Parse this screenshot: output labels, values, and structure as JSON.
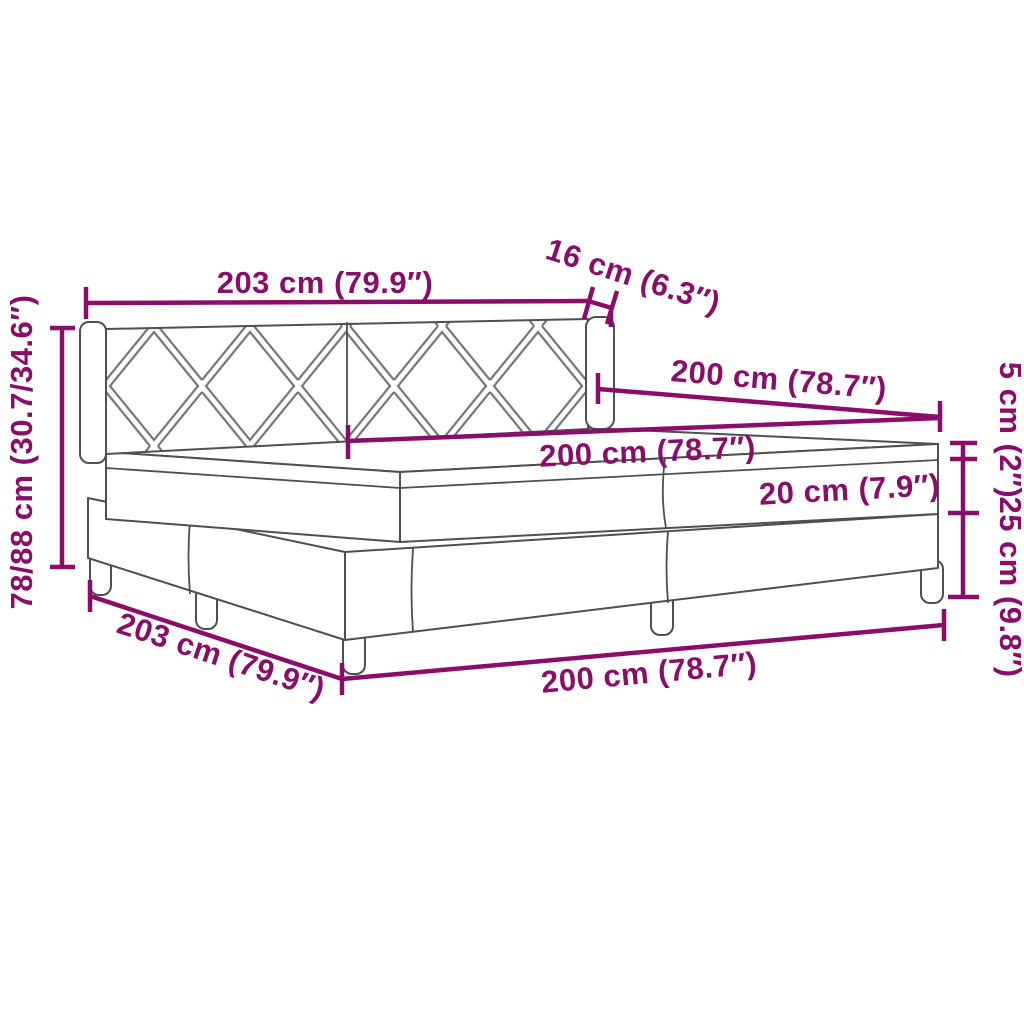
{
  "diagram": {
    "type": "product-dimension-diagram",
    "product": "box-spring-bed-with-headboard-and-mattress",
    "accent_color": "#8a0d6a",
    "drawing_line_color": "#4f4f4f",
    "background_color": "#ffffff",
    "dimensions": {
      "headboard_width": "203 cm (79.9″)",
      "headboard_depth": "16 cm (6.3″)",
      "bed_inner_length": "200 cm (78.7″)",
      "mattress_length": "200 cm (78.7″)",
      "topper_height": "5 cm (2″)",
      "mattress_height": "20 cm (7.9″)",
      "base_height": "25 cm (9.8″)",
      "total_height": "78/88 cm (30.7/34.6″)",
      "base_width": "203 cm (79.9″)",
      "base_length": "200 cm (78.7″)"
    }
  }
}
